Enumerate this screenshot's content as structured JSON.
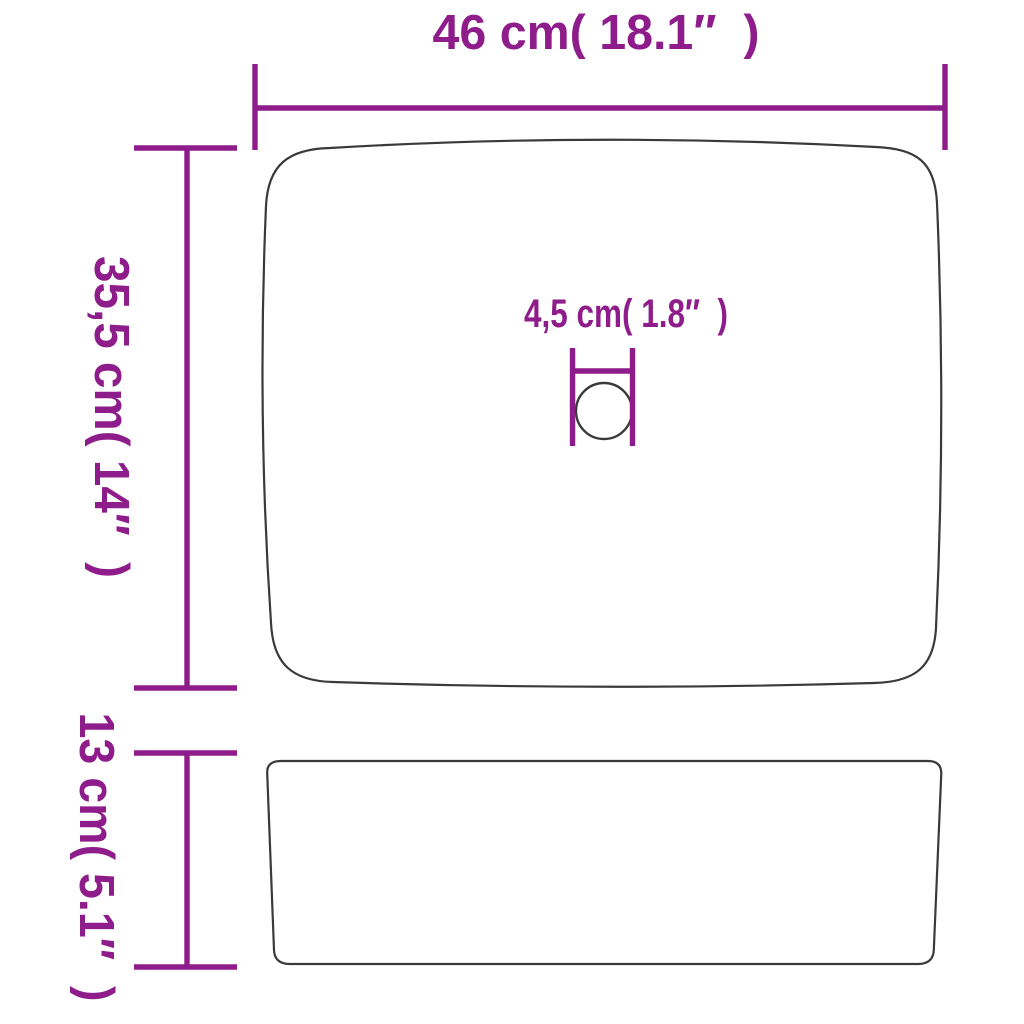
{
  "colors": {
    "dimension_lines": "#8E1C8A",
    "product_outline": "#3A3A3A",
    "background": "#FFFFFF"
  },
  "dimensions": {
    "width": {
      "label": "46 cm( 18.1″  )",
      "cm": "46",
      "inch": "18.1"
    },
    "depth": {
      "label": "35,5 cm( 14″  )",
      "cm": "35,5",
      "inch": "14"
    },
    "drain": {
      "label": "4,5 cm( 1.8″  )",
      "cm": "4,5",
      "inch": "1.8"
    },
    "height": {
      "label": "13 cm( 5.1″  )",
      "cm": "13",
      "inch": "5.1"
    }
  }
}
